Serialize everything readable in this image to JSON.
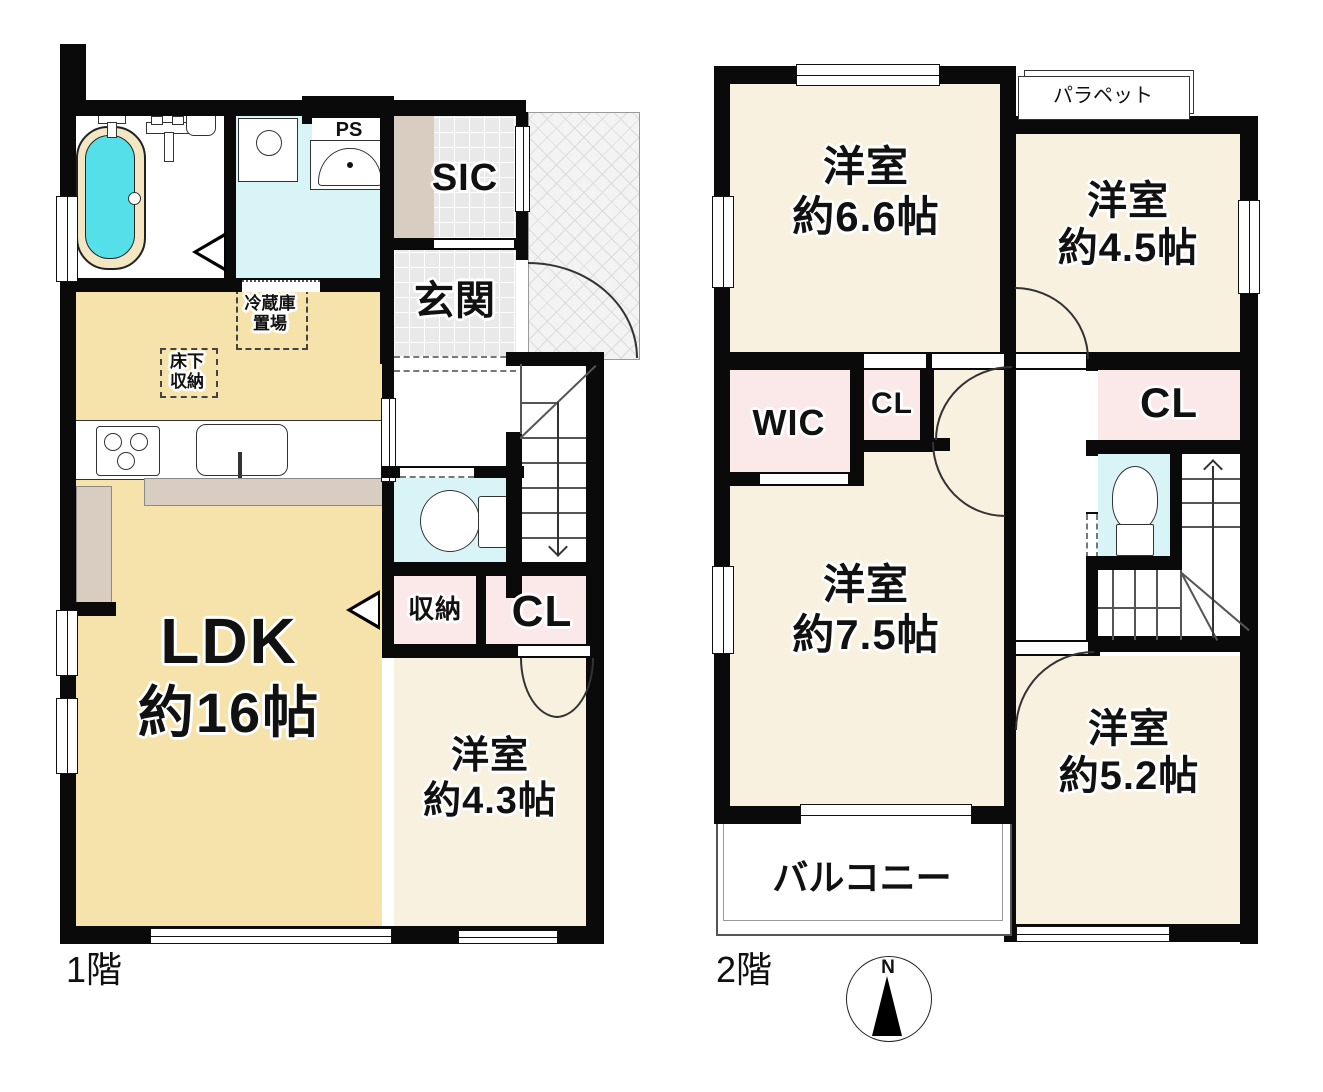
{
  "title": "間取り図",
  "colors": {
    "wall": "#0a0a0a",
    "ldk": "#F6E3AC",
    "cream": "#F8F1E0",
    "pink": "#FBE9E9",
    "cyan": "#D9F4F7",
    "tub": "#55DFE8",
    "tubrim": "#F3E6C3",
    "tile": "#E9E9E9",
    "tan": "#D9CCC0",
    "porch": "#F3F3F3"
  },
  "floor1": {
    "label": "1階",
    "ldk": {
      "line1": "LDK",
      "line2": "約16帖"
    },
    "bedroom43": {
      "line1": "洋室",
      "line2": "約4.3帖"
    },
    "sic": "SIC",
    "genkan": "玄関",
    "shunou": "収納",
    "cl": "CL",
    "ps": "PS",
    "fridge": {
      "line1": "冷蔵庫",
      "line2": "置場"
    },
    "underfloor": {
      "line1": "床下",
      "line2": "収納"
    }
  },
  "floor2": {
    "label": "2階",
    "bedroom66": {
      "line1": "洋室",
      "line2": "約6.6帖"
    },
    "bedroom45": {
      "line1": "洋室",
      "line2": "約4.5帖"
    },
    "bedroom75": {
      "line1": "洋室",
      "line2": "約7.5帖"
    },
    "bedroom52": {
      "line1": "洋室",
      "line2": "約5.2帖"
    },
    "wic": "WIC",
    "cl_left": "CL",
    "cl_right": "CL",
    "balcony": "バルコニー",
    "parapet": "パラペット"
  },
  "compass": {
    "north": "N"
  }
}
